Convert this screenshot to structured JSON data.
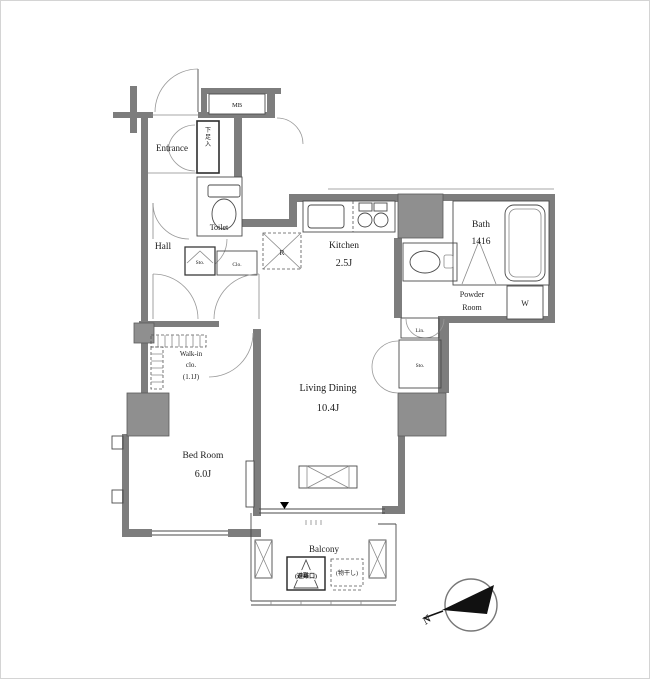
{
  "colors": {
    "wall": "#7d7d7d",
    "shaft": "#8f8f8f",
    "line": "#4a4a4a",
    "text": "#1c1c1c",
    "background": "#ffffff"
  },
  "labels": {
    "meter_box": "MB",
    "entrance": "Entrance",
    "shoe_cabinet": "下足入",
    "toilet": "Toilet",
    "hall": "Hall",
    "hall_storage": "Sto.",
    "hall_closet": "Clo.",
    "refrigerator": "R",
    "kitchen": "Kitchen",
    "kitchen_size": "2.5J",
    "bath": "Bath",
    "bath_size": "1416",
    "powder_line1": "Powder",
    "powder_line2": "Room",
    "washer": "W",
    "linen": "Lin.",
    "storage": "Sto.",
    "living": "Living Dining",
    "living_size": "10.4J",
    "wic_line1": "Walk-in",
    "wic_line2": "clo.",
    "wic_line3": "(1.1J)",
    "bedroom": "Bed Room",
    "bedroom_size": "6.0J",
    "balcony": "Balcony",
    "balcony_hatch": "(避難口)",
    "balcony_drying": "(物干し)",
    "compass_north": "N"
  }
}
